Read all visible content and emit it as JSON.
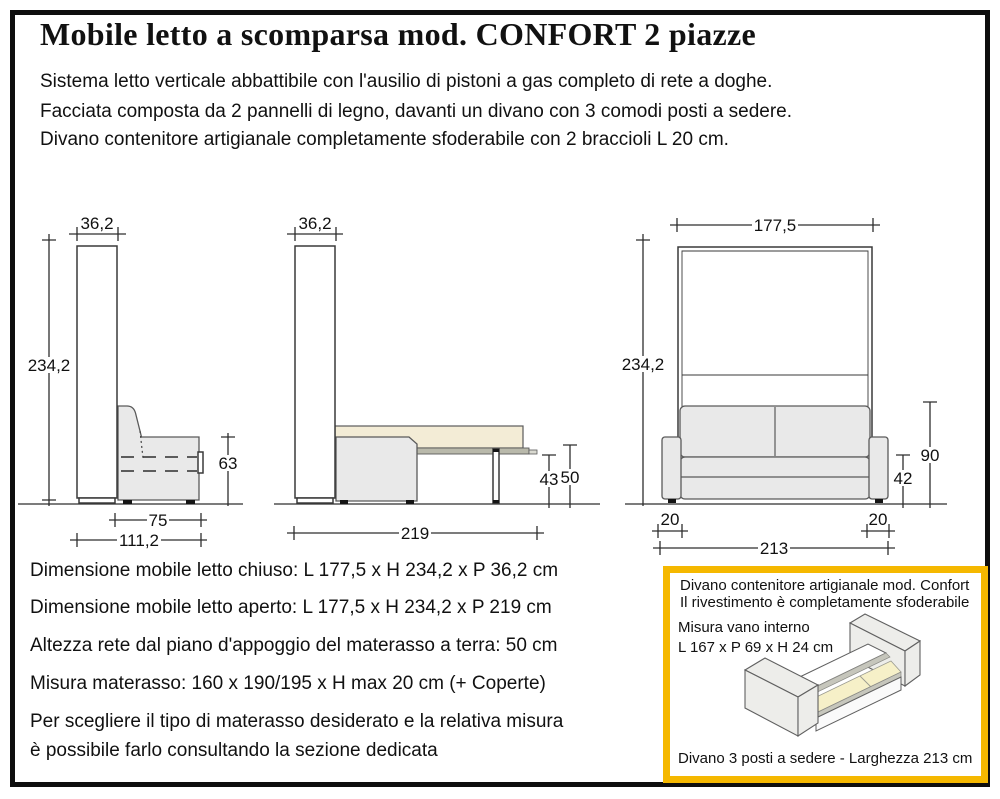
{
  "header": {
    "title": "Mobile letto a scomparsa mod. CONFORT 2 piazze",
    "description": [
      "Sistema letto verticale abbattibile con l'ausilio di pistoni a gas completo di rete a doghe.",
      "Facciata composta da 2 pannelli di legno, davanti un divano con 3 comodi posti a sedere.",
      "Divano contenitore artigianale completamente sfoderabile con 2 braccioli L 20 cm."
    ]
  },
  "dims": {
    "closed": {
      "depth": "36,2",
      "height": "234,2",
      "sofa_height": "63",
      "sofa_depth": "75",
      "total_depth": "111,2"
    },
    "open": {
      "depth": "36,2",
      "total_depth": "219",
      "frame_height": "43",
      "bed_height": "50"
    },
    "front": {
      "width": "177,5",
      "height": "234,2",
      "backrest_height": "90",
      "seat_height": "42",
      "armrest_left": "20",
      "armrest_right": "20",
      "sofa_width": "213"
    }
  },
  "specs": [
    "Dimensione mobile letto chiuso: L 177,5 x H 234,2 x P 36,2 cm",
    "Dimensione mobile letto aperto: L 177,5 x H 234,2 x P 219 cm",
    "Altezza rete dal piano d'appoggio del materasso a terra: 50 cm",
    "Misura materasso: 160 x 190/195 x H max 20 cm (+ Coperte)",
    "Per scegliere il tipo di materasso desiderato e la relativa misura",
    "è possibile farlo consultando la sezione dedicata"
  ],
  "info_box": {
    "line1": "Divano contenitore artigianale mod. Confort",
    "line2": "Il rivestimento è completamente sfoderabile",
    "measure_label": "Misura vano interno",
    "measure_value": "L 167 x P 69 x H 24 cm",
    "footer": "Divano 3 posti a sedere - Larghezza 213 cm"
  },
  "colors": {
    "accent_gold": "#F5B800",
    "frame_black": "#0e0e0e",
    "line": "#2e2e2e",
    "sofa_fill": "#e9e9e9",
    "mattress_fill": "#f3ecd6",
    "slat_fill": "#f6f0c8",
    "platform_fill": "#b9b9ab"
  }
}
